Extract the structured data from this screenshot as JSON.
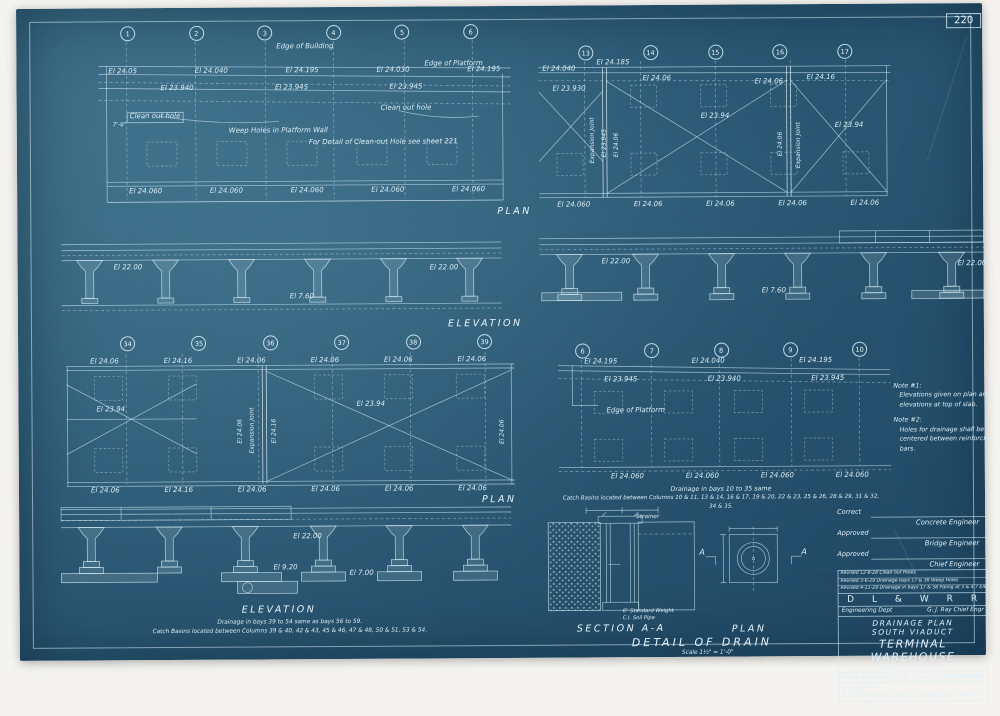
{
  "sheet": {
    "number_top_right": "220",
    "number_bottom_left": "220"
  },
  "headers": {
    "plan_top": "PLAN",
    "elevation_mid": "ELEVATION",
    "plan_bottom": "PLAN",
    "elevation_bottom": "ELEVATION",
    "section": "SECTION A-A",
    "detail_plan": "PLAN",
    "detail_title": "DETAIL OF DRAIN",
    "detail_scale": "Scale 1½\" = 1'-0\""
  },
  "plan_tl": {
    "columns": [
      "1",
      "2",
      "3",
      "4",
      "5",
      "6"
    ],
    "edge_of_building": "Edge of Building",
    "edge_of_platform": "Edge of Platform",
    "elev_row_top": [
      "El 24.05",
      "El 24.040",
      "El 24.195",
      "El 24.030",
      "El 24.195"
    ],
    "elev_row_mid": [
      "El 23.940",
      "El 23.945",
      "El 23.945"
    ],
    "clean_out_left": "Clean out hole",
    "clean_out_right": "Clean out hole",
    "weep_holes": "Weep Holes in Platform Wall",
    "detail_note": "For Detail of Clean-out Hole see sheet 221",
    "dim_left": "7'-6\"",
    "elev_row_bottom": [
      "El 24.060",
      "El 24.060",
      "El 24.060",
      "El 24.060",
      "El 24.060"
    ]
  },
  "plan_tr": {
    "columns": [
      "13",
      "14",
      "15",
      "16",
      "17"
    ],
    "top_labels": [
      "El 24.040",
      "El 24.185",
      "El 24.06",
      "El 24.06",
      "El 24.16"
    ],
    "el_23_930": "El 23.930",
    "vert_exp_joint": "Expansion Joint",
    "vert_el_23_945": "El 23.945",
    "vert_el_24_06_a": "El 24.06",
    "vert_el_24_06_b": "El 24.06",
    "vert_exp_joint2": "Expansion Joint",
    "x_label_main": "El 23.94",
    "x_label_right": "El 23.94",
    "elev_row_bottom": [
      "El 24.060",
      "El 24.06",
      "El 24.06",
      "El 24.06",
      "El 24.06"
    ]
  },
  "elev_ml": {
    "el_top_left": "El 22.00",
    "el_top_right": "El 22.00",
    "el_base": "El 7.60"
  },
  "elev_mr": {
    "el_top_left": "El 22.00",
    "el_top_right": "El 22.00",
    "el_base": "El 7.60"
  },
  "plan_bl": {
    "columns": [
      "34",
      "35",
      "36",
      "37",
      "38",
      "39"
    ],
    "elev_row_top": [
      "El 24.06",
      "El 24.16",
      "El 24.06",
      "El 24.06",
      "El 24.06",
      "El 24.06"
    ],
    "x_label_left": "El 23.94",
    "x_label_main": "El 23.94",
    "vert_el_24_06_a": "El 24.06",
    "vert_exp_joint": "Expansion Joint",
    "vert_el_24_16": "El 24.16",
    "vert_el_24_06_right": "El 24.06",
    "elev_row_bottom": [
      "El 24.06",
      "El 24.16",
      "El 24.06",
      "El 24.06",
      "El 24.06",
      "El 24.06"
    ]
  },
  "plan_br": {
    "columns": [
      "6",
      "7",
      "8",
      "9",
      "10"
    ],
    "elev_row_top": [
      "El 24.195",
      "El 24.040",
      "El 24.195"
    ],
    "elev_row_mid": [
      "El 23.945",
      "El 23.940",
      "El 23.945"
    ],
    "edge_of_platform": "Edge of Platform",
    "elev_row_bottom": [
      "El 24.060",
      "El 24.060",
      "El 24.060",
      "El 24.060"
    ],
    "note_line1": "Drainage in bays 10 to 35 same",
    "note_line2": "Catch Basins located between Columns 10 & 11, 13 & 14, 16 & 17, 19 & 20, 22 & 23, 25 & 26, 28 & 29, 31 & 32, 34 & 35."
  },
  "side_notes": {
    "note1_title": "Note #1:",
    "note1_body": "Elevations given on plan are elevations at top of slab.",
    "note2_title": "Note #2:",
    "note2_body": "Holes for drainage shall be centered between reinforcing bars."
  },
  "elev_bl": {
    "el_top": "El 22.00",
    "el_mid": "El 9.20",
    "el_base": "El 7.00",
    "note_line1": "Drainage in bays 39 to 54 same as bays 56 to 59.",
    "note_line2": "Catch Basins located between Columns 39 & 40, 42 & 43, 45 & 46, 47 & 48, 50 & 51, 53 & 54."
  },
  "detail": {
    "strainer": "Strainer",
    "pipe_note_line1": "6\" Standard Weight",
    "pipe_note_line2": "C.I. Soil Pipe",
    "arrow_a_left": "A",
    "arrow_a_right": "A"
  },
  "title_block": {
    "correct": "Correct",
    "concrete_engineer": "Concrete Engineer",
    "approved1": "Approved",
    "bridge_engineer": "Bridge Engineer",
    "approved2": "Approved",
    "chief_engineer": "Chief Engineer",
    "revisions": [
      "Revised 12-8-28  Clean out Holes",
      "Revised 3-6-29  Drainage bays 17 & 38  Weep Holes",
      "Revised 4-11-29  Drainage in bays 17 & 38  Piping at 3 & 4  7 Elev"
    ],
    "railroad_letters": [
      "D",
      "L",
      "&",
      "W",
      "R",
      "R"
    ],
    "dept": "Engineering Dept",
    "chief": "G. J. Ray  Chief Engr",
    "title_line1": "DRAINAGE PLAN",
    "title_line2": "SOUTH VIADUCT",
    "title_line3": "TERMINAL WAREHOUSE",
    "title_line4": "JERSEY CITY, N.J.",
    "scale": "Scale 1\"=10'",
    "bridge_dept": "Bridge Dept",
    "designed": "Designed C.T.K.",
    "traced": "Traced C.T.K.",
    "checked": "Checked H.D.",
    "sheet_line": "Sheet    of    Sheets",
    "location": "Hoboken, N.J.",
    "date": "Feb 6, '29"
  }
}
